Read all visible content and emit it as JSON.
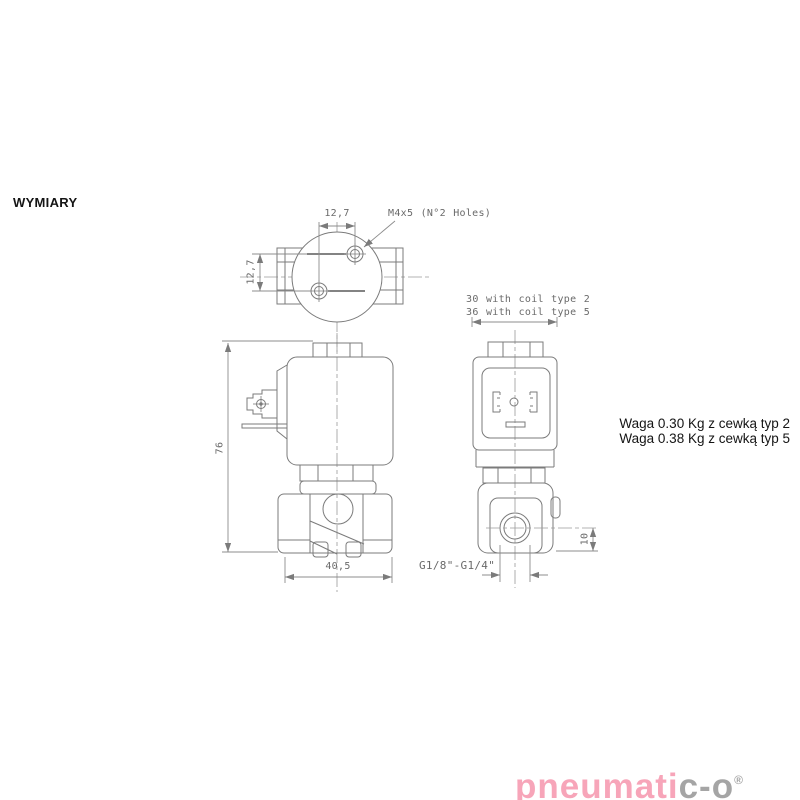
{
  "page": {
    "title": "WYMIARY"
  },
  "drawing": {
    "top_view": {
      "dim_hole_spacing_h": "12,7",
      "dim_hole_spacing_v": "12,7",
      "holes_note": "M4x5 (N°2 Holes)"
    },
    "front_view": {
      "dim_overall_height": "76",
      "dim_body_width": "40,5"
    },
    "side_view": {
      "depth_note_line1": "30 with coil type 2",
      "depth_note_line2": "36 with coil type 5",
      "dim_port_offset": "10",
      "thread_label": "G1/8\"-G1/4\""
    }
  },
  "notes": {
    "weight_line1": "Waga 0.30 Kg z cewką typ 2",
    "weight_line2": "Waga 0.38 Kg z cewką typ 5"
  },
  "logo": {
    "text_primary": "pneumati",
    "text_secondary": "c-o",
    "registered_mark": "®",
    "color_primary": "#f7a5b9",
    "color_secondary": "#a5a5a5"
  },
  "colors": {
    "drawing_line": "#7b7b7b",
    "dimension_line": "#8c8c8c",
    "dimension_text": "#6a6a6a",
    "body_text": "#141414"
  }
}
